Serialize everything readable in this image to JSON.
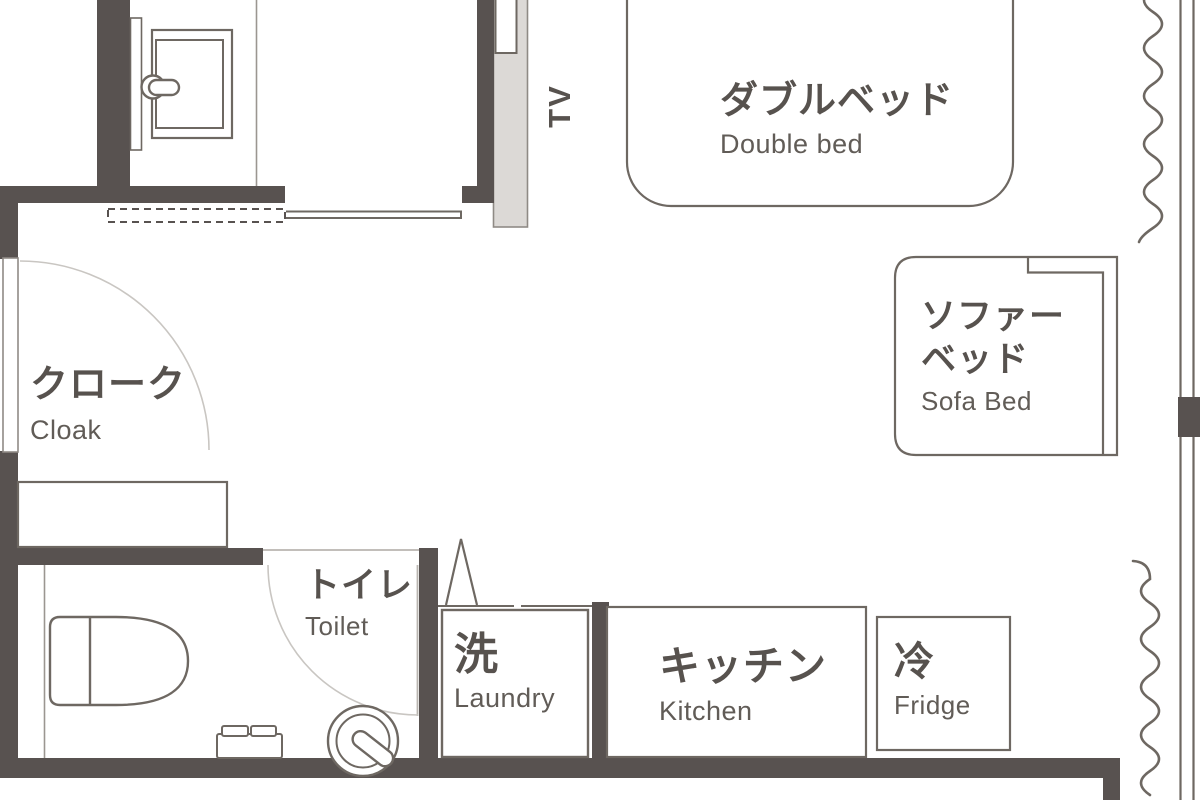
{
  "title": "studio-room-floor-plan",
  "colors": {
    "wall": "#585250",
    "line": "#6e6862",
    "thin_line": "#9b9691",
    "door_arc": "#c9c6c2",
    "light_fill": "#dcd9d6",
    "text": "#57524e",
    "text_sub": "#615c57",
    "background": "#ffffff"
  },
  "labels": {
    "tv": "TV",
    "double_bed": {
      "ja": "ダブルベッド",
      "en": "Double bed"
    },
    "sofa_bed": {
      "ja1": "ソファー",
      "ja2": "ベッド",
      "en": "Sofa Bed"
    },
    "cloak": {
      "ja": "クローク",
      "en": "Cloak"
    },
    "toilet": {
      "ja": "トイレ",
      "en": "Toilet"
    },
    "laundry": {
      "ja": "洗",
      "en": "Laundry"
    },
    "kitchen": {
      "ja": "キッチン",
      "en": "Kitchen"
    },
    "fridge": {
      "ja": "冷",
      "en": "Fridge"
    }
  }
}
